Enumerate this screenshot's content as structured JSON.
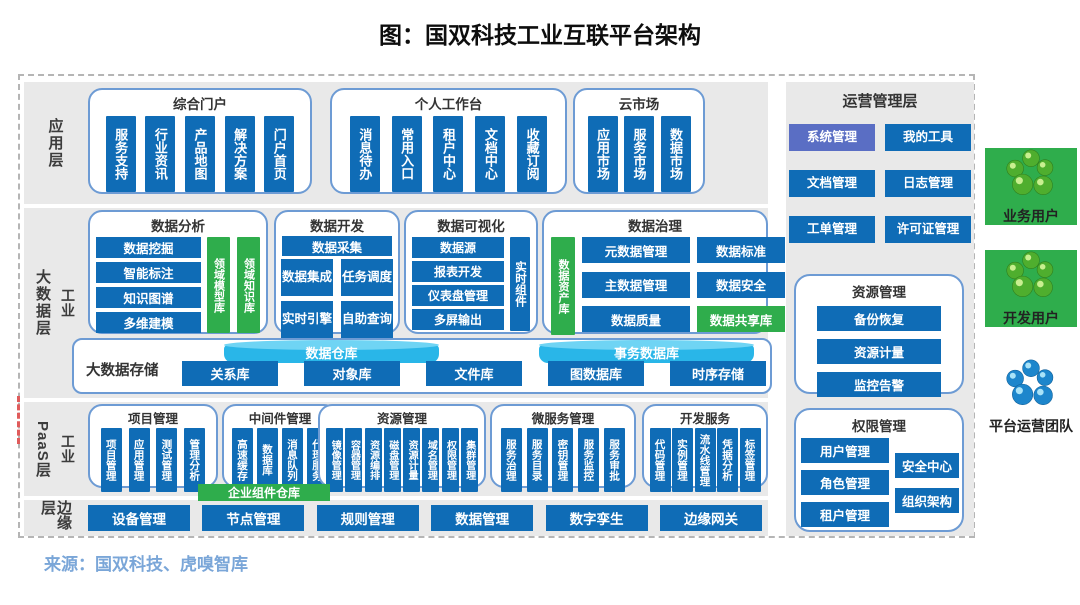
{
  "title": "图：国双科技工业互联平台架构",
  "source": "来源：国双科技、虎嗅智库",
  "colors": {
    "box_blue": "#0f6cb6",
    "green": "#2fad4c",
    "section_border": "#6d9bd4",
    "cylinder_blue": "#29b6e8",
    "alt_button_blue": "#5a6ec4",
    "source_text_blue": "#7aa6d8",
    "row_gray": "#e9e9e9"
  },
  "layers": {
    "app": {
      "label": "应用层",
      "sections": [
        {
          "title": "综合门户",
          "items": [
            "服务支持",
            "行业资讯",
            "产品地图",
            "解决方案",
            "门户首页"
          ]
        },
        {
          "title": "个人工作台",
          "items": [
            "消息待办",
            "常用入口",
            "租户中心",
            "文档中心",
            "收藏订阅"
          ]
        },
        {
          "title": "云市场",
          "items": [
            "应用市场",
            "服务市场",
            "数据市场"
          ]
        }
      ]
    },
    "bigdata": {
      "label": "大数据层",
      "sublabel": "工业",
      "analysis": {
        "title": "数据分析",
        "rows": [
          "数据挖掘",
          "智能标注",
          "知识图谱",
          "多维建模"
        ],
        "knowledge": [
          "领域模型库",
          "领域知识库"
        ]
      },
      "dev": {
        "title": "数据开发",
        "top": "数据采集",
        "grid": [
          "数据集成",
          "任务调度",
          "实时引擎",
          "自助查询"
        ]
      },
      "viz": {
        "title": "数据可视化",
        "rows": [
          "数据源",
          "报表开发",
          "仪表盘管理",
          "多屏输出"
        ],
        "side": "实时组件"
      },
      "gov": {
        "title": "数据治理",
        "asset": "数据资产库",
        "grid": [
          {
            "label": "元数据管理"
          },
          {
            "label": "数据标准"
          },
          {
            "label": "主数据管理"
          },
          {
            "label": "数据安全"
          },
          {
            "label": "数据质量"
          },
          {
            "label": "数据共享库",
            "variant": "green"
          }
        ]
      },
      "storage": {
        "label": "大数据存储",
        "cylinders": [
          "数据仓库",
          "事务数据库"
        ],
        "stores": [
          "关系库",
          "对象库",
          "文件库",
          "图数据库",
          "时序存储"
        ]
      }
    },
    "paas": {
      "label": "PaaS层",
      "sublabel": "工业",
      "repo": "企业组件仓库",
      "sections": [
        {
          "title": "项目管理",
          "items": [
            "项目管理",
            "应用管理",
            "测试管理",
            "管理分析"
          ]
        },
        {
          "title": "中间件管理",
          "items": [
            "高速缓存",
            "数据库",
            "消息队列",
            "代理服务"
          ]
        },
        {
          "title": "资源管理",
          "items": [
            "镜像管理",
            "容器管理",
            "资源编排",
            "磁盘管理",
            "资源计量",
            "域名管理",
            "权限管理",
            "集群管理"
          ]
        },
        {
          "title": "微服务管理",
          "items": [
            "服务治理",
            "服务目录",
            "密钥管理",
            "服务监控",
            "服务审批"
          ]
        },
        {
          "title": "开发服务",
          "items": [
            "代码管理",
            "实例管理",
            "流水线管理",
            "凭据分析",
            "标签管理"
          ]
        }
      ]
    },
    "edge": {
      "label": "边缘层",
      "items": [
        "设备管理",
        "节点管理",
        "规则管理",
        "数据管理",
        "数字孪生",
        "边缘网关"
      ]
    }
  },
  "ops": {
    "title": "运营管理层",
    "buttons": [
      {
        "label": "系统管理",
        "variant": "alt"
      },
      {
        "label": "我的工具"
      },
      {
        "label": "文档管理"
      },
      {
        "label": "日志管理"
      },
      {
        "label": "工单管理"
      },
      {
        "label": "许可证管理"
      }
    ],
    "resource": {
      "title": "资源管理",
      "items": [
        "备份恢复",
        "资源计量",
        "监控告警"
      ]
    },
    "permission": {
      "title": "权限管理",
      "left": [
        "用户管理",
        "角色管理",
        "租户管理"
      ],
      "right": [
        "安全中心",
        "组织架构"
      ]
    }
  },
  "users": [
    {
      "id": "business-users",
      "label": "业务用户",
      "color": "green"
    },
    {
      "id": "developer-users",
      "label": "开发用户",
      "color": "green"
    },
    {
      "id": "platform-ops-team",
      "label": "平台运营团队",
      "color": "blue"
    }
  ]
}
